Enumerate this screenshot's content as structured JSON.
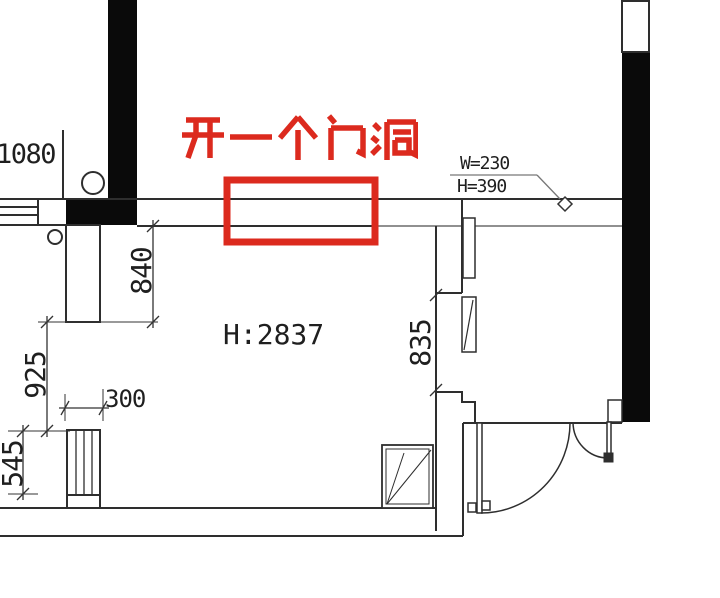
{
  "plan": {
    "note": {
      "text": "开一个门洞",
      "color": "#dc2a1e"
    },
    "labels": {
      "top_left": "1080",
      "door_width": "W=230",
      "door_height": "H=390",
      "room_height": "H:2837"
    },
    "dims": {
      "v840": "840",
      "v925": "925",
      "v545": "545",
      "v300": "300",
      "v835": "835"
    }
  }
}
